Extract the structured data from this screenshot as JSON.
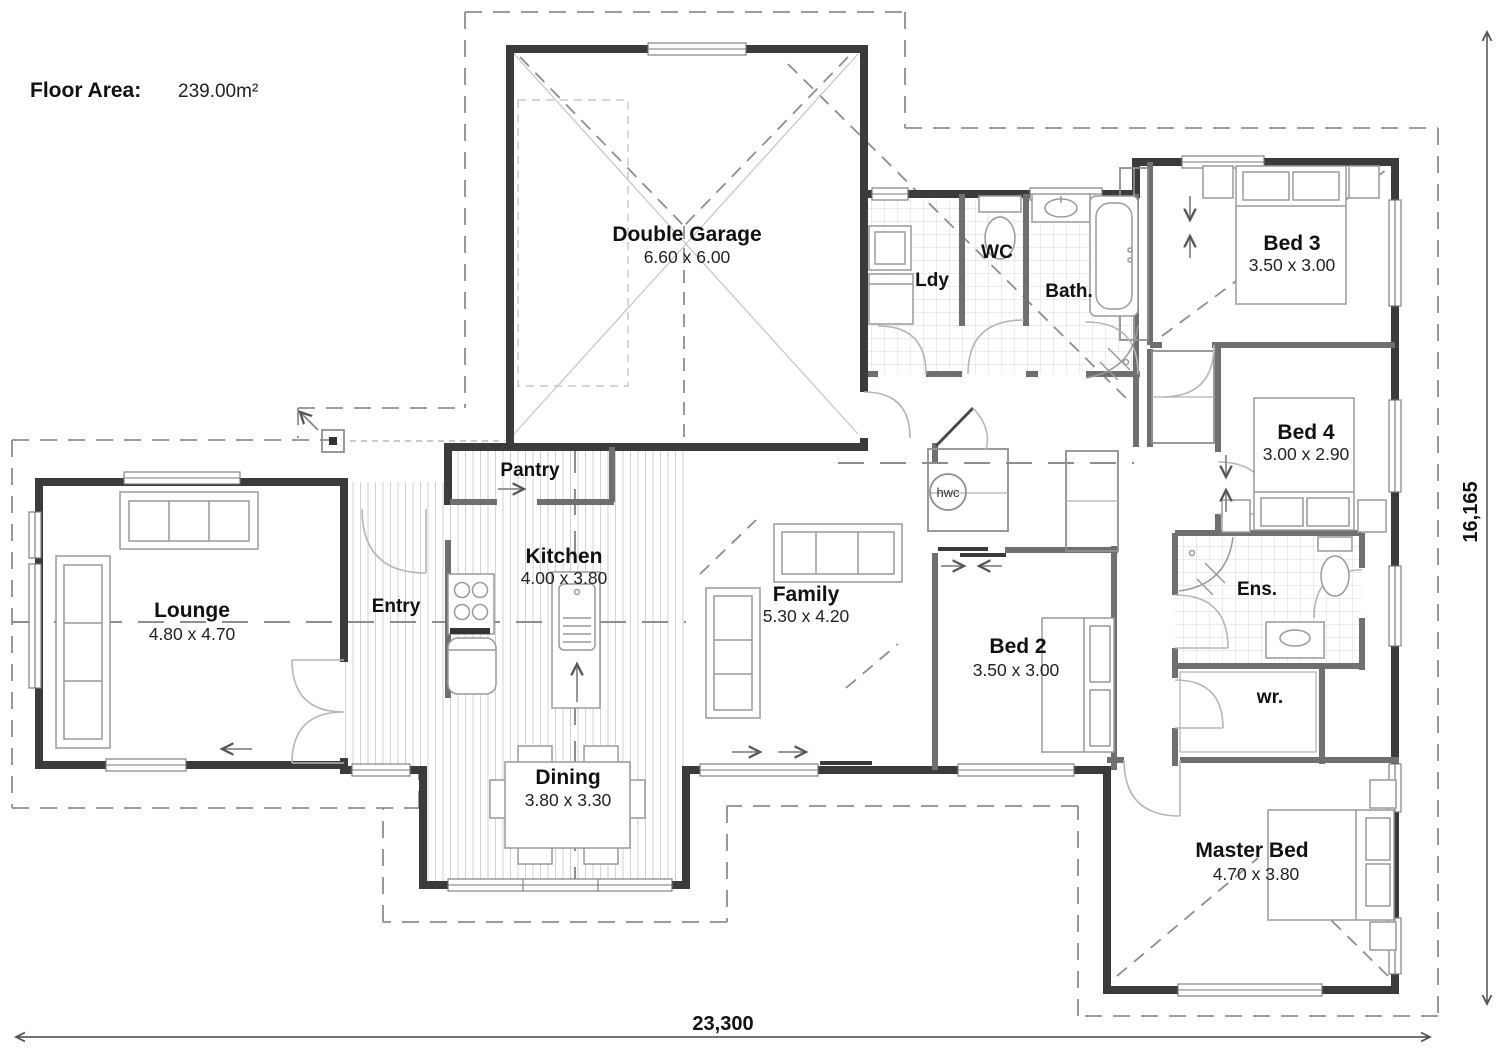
{
  "header": {
    "floor_area_label": "Floor Area:",
    "floor_area_value": "239.00m²"
  },
  "dimensions": {
    "overall_width": "23,300",
    "overall_height": "16,165"
  },
  "rooms": [
    {
      "id": "double-garage",
      "name": "Double Garage",
      "size": "6.60 x 6.00"
    },
    {
      "id": "lounge",
      "name": "Lounge",
      "size": "4.80 x 4.70"
    },
    {
      "id": "entry",
      "name": "Entry",
      "size": ""
    },
    {
      "id": "pantry",
      "name": "Pantry",
      "size": ""
    },
    {
      "id": "kitchen",
      "name": "Kitchen",
      "size": "4.00 x 3.80"
    },
    {
      "id": "dining",
      "name": "Dining",
      "size": "3.80 x 3.30"
    },
    {
      "id": "family",
      "name": "Family",
      "size": "5.30 x 4.20"
    },
    {
      "id": "laundry",
      "name": "Ldy",
      "size": ""
    },
    {
      "id": "wc",
      "name": "WC",
      "size": ""
    },
    {
      "id": "bathroom",
      "name": "Bath.",
      "size": ""
    },
    {
      "id": "bed-3",
      "name": "Bed 3",
      "size": "3.50 x 3.00"
    },
    {
      "id": "bed-4",
      "name": "Bed 4",
      "size": "3.00 x 2.90"
    },
    {
      "id": "bed-2",
      "name": "Bed 2",
      "size": "3.50 x 3.00"
    },
    {
      "id": "ensuite",
      "name": "Ens.",
      "size": ""
    },
    {
      "id": "walk-in-robe",
      "name": "wr.",
      "size": ""
    },
    {
      "id": "master-bed",
      "name": "Master Bed",
      "size": "4.70 x 3.80"
    },
    {
      "id": "hot-water-cylinder",
      "name": "hwc",
      "size": ""
    }
  ],
  "colors": {
    "wall": "#3b3b3b",
    "interior_wall": "#6f6f6f",
    "roofline": "#8e8e8e",
    "text": "#111111"
  }
}
